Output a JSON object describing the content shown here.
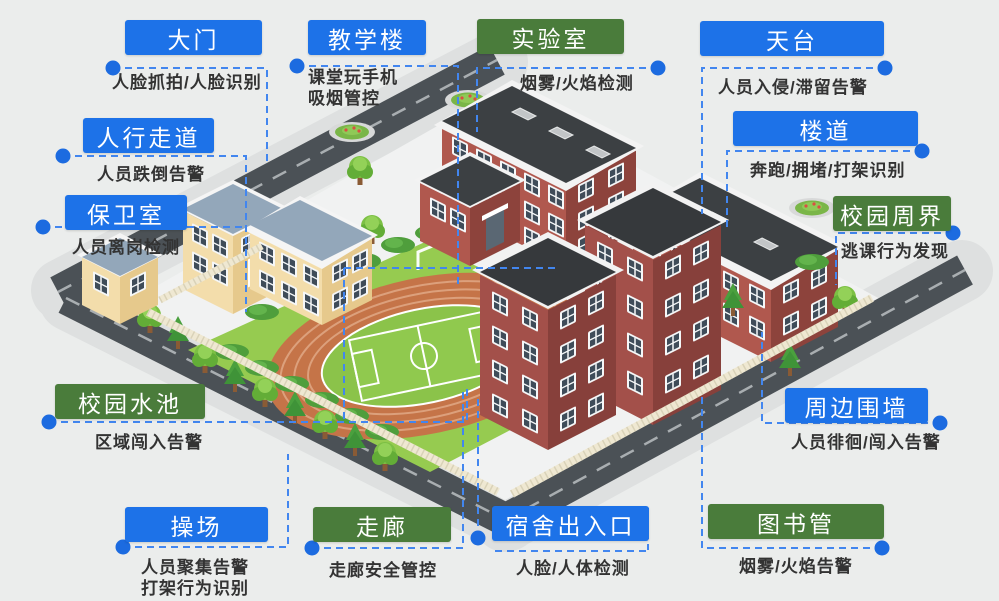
{
  "colors": {
    "label_blue": "#1d72e8",
    "label_green": "#4a7c3b",
    "connector_blue": "#4286ef",
    "dot_blue": "#1c6be0",
    "background": "#ebedec"
  },
  "labels": [
    {
      "id": "gate",
      "title": "大门",
      "type": "blue",
      "desc": "人脸抓拍/人脸识别"
    },
    {
      "id": "teaching-building",
      "title": "教学楼",
      "type": "blue",
      "desc": "课堂玩手机",
      "desc2": "吸烟管控"
    },
    {
      "id": "laboratory",
      "title": "实验室",
      "type": "green",
      "desc": "烟雾/火焰检测"
    },
    {
      "id": "rooftop",
      "title": "天台",
      "type": "blue",
      "desc": "人员入侵/滞留告警"
    },
    {
      "id": "walkway",
      "title": "人行走道",
      "type": "blue",
      "desc": "人员跌倒告警"
    },
    {
      "id": "stair-corridor",
      "title": "楼道",
      "type": "blue",
      "desc": "奔跑/拥堵/打架识别"
    },
    {
      "id": "guard-room",
      "title": "保卫室",
      "type": "blue",
      "desc": "人员离岗检测"
    },
    {
      "id": "campus-perimeter",
      "title": "校园周界",
      "type": "green",
      "desc": "逃课行为发现"
    },
    {
      "id": "campus-pool",
      "title": "校园水池",
      "type": "green",
      "desc": "区域闯入告警"
    },
    {
      "id": "perimeter-wall",
      "title": "周边围墙",
      "type": "blue",
      "desc": "人员徘徊/闯入告警"
    },
    {
      "id": "playground",
      "title": "操场",
      "type": "blue",
      "desc": "人员聚集告警",
      "desc2": "打架行为识别"
    },
    {
      "id": "hallway",
      "title": "走廊",
      "type": "green",
      "desc": "走廊安全管控"
    },
    {
      "id": "dorm-entrance",
      "title": "宿舍出入口",
      "type": "blue",
      "desc": "人脸/人体检测"
    },
    {
      "id": "library",
      "title": "图书管",
      "type": "green",
      "desc": "烟雾/火焰告警"
    }
  ]
}
